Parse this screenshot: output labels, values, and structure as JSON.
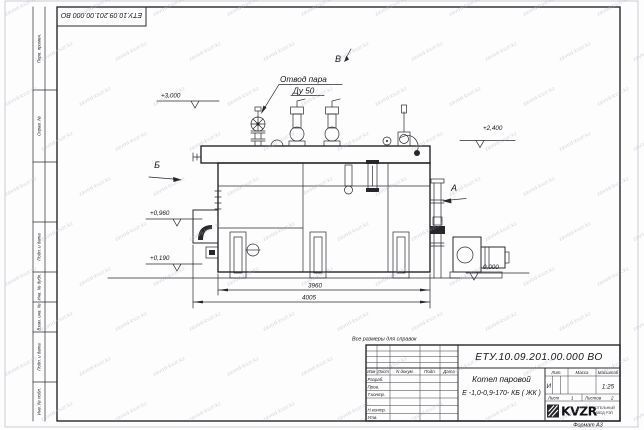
{
  "watermark": {
    "text": "zavod-kvzr.kz"
  },
  "frame": {
    "top_stamp": "ЕТУ.10.09.201.00.000  ВО",
    "format_label": "Формат А3",
    "side_labels": {
      "perv_primen": "Перв. примен.",
      "sprav_no": "Справ. №",
      "podp_data_1": "Подп. и дата",
      "inv_dubl": "Инв. № дубл.",
      "vzam_inv": "Взам. инв. №",
      "podp_data_2": "Подп. и дата",
      "inv_podl": "Инв. № подл."
    }
  },
  "drawing": {
    "note": "Все размеры для справок",
    "labels": {
      "steam_outlet_1": "Отвод пара",
      "steam_outlet_2": "Ду 50",
      "view_a": "А",
      "view_b": "Б",
      "view_v": "В"
    },
    "elevations": {
      "e3000": "+3,000",
      "e2400": "+2,400",
      "e0960": "+0,960",
      "e0190": "+0,190",
      "e0000": "0,000"
    },
    "dimensions": {
      "d3960": "3960",
      "d4005": "4005"
    }
  },
  "title_block": {
    "doc_number": "ЕТУ.10.09.201.00.000  ВО",
    "columns": {
      "izm": "Изм",
      "list": "Лист",
      "doc": "N докум.",
      "podp": "Подп.",
      "data": "Дата"
    },
    "rows": {
      "razrab": "Разраб.",
      "prov": "Пров.",
      "tkontr": "Т.контр.",
      "nkontr": "Н.контр.",
      "utv": "Утв."
    },
    "product_1": "Котел паровой",
    "product_2": "Е -1,0-0,9-170- КБ ( ЖК )",
    "lit_label": "Лит.",
    "mass_label": "Масса",
    "scale_label": "Масштаб",
    "lit_value": "И",
    "scale_value": "1:25",
    "sheet_label": "Лист",
    "sheet_value": "1",
    "sheets_label": "Листов",
    "sheets_value": "2",
    "logo_name": "KVZR",
    "logo_sub_1": "КОТЕЛЬНЫЙ",
    "logo_sub_2": "ЗАВОД РЭП"
  }
}
